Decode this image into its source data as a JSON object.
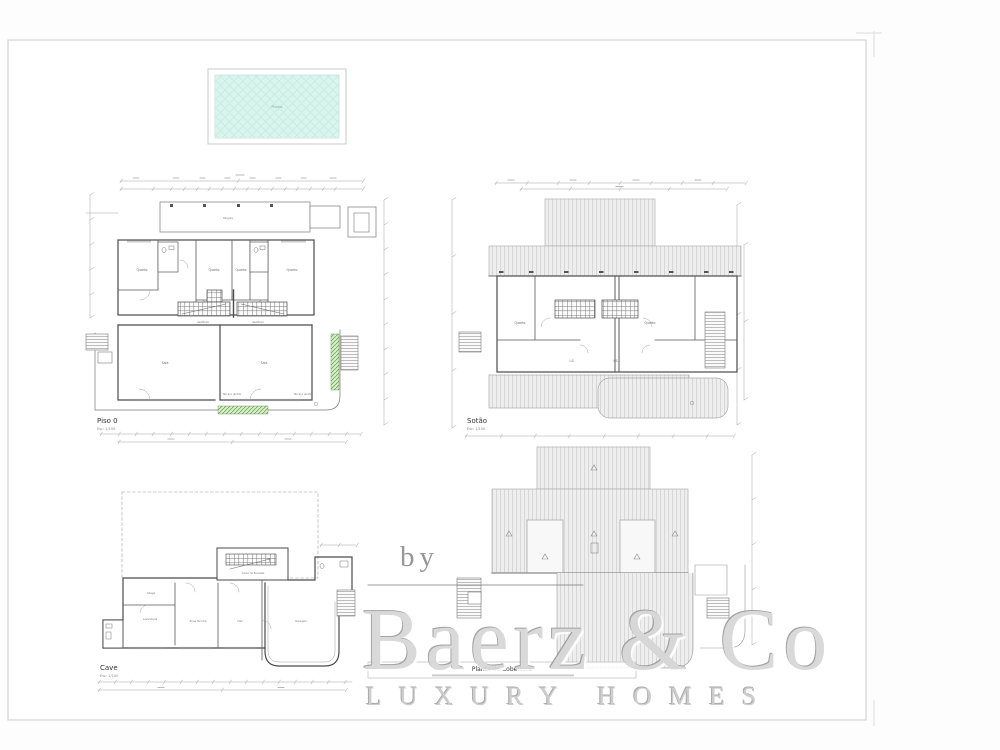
{
  "pool": {
    "label": "Piscina"
  },
  "plans": {
    "piso0": {
      "title": "Piso 0",
      "scale": "Esc: 1/100",
      "rooms": {
        "pergola": "Pérgola",
        "quarto1": "Quarto",
        "quarto2": "Quarto",
        "quarto3": "Quarto",
        "quarto4": "Quarto",
        "vestibulo1": "Vestíbulo",
        "vestibulo2": "Vestíbulo",
        "sala1": "Sala",
        "sala2": "Sala",
        "terraco1": "Terraço jardim",
        "terraco2": "Terraço jardim"
      }
    },
    "sotao": {
      "title": "Sotão",
      "scale": "Esc: 1/100",
      "rooms": {
        "quarto_esq": "Quarto",
        "quarto_dir": "Quarto",
        "is_esq": "I.S.",
        "is_dir": "I.S."
      }
    },
    "cave": {
      "title": "Cave",
      "scale": "Esc: 1/100",
      "rooms": {
        "escadas": "Caixa de Escadas",
        "adega": "Adega",
        "lavandaria": "Lavandaria",
        "zona_tecnica": "Zona Técnica",
        "hall": "Hall",
        "garagem": "Garagem"
      }
    },
    "cobertura": {
      "title": "Planta de Cobertura"
    }
  },
  "watermark": {
    "by": "by",
    "name": "Baerz & Co",
    "tagline": "LUXURY HOMES"
  },
  "colors": {
    "pool_water": "#d9f5ed",
    "planter_green": "#6fae57",
    "roof_hatch": "#eeeeee",
    "wall_line": "#4a4a4a",
    "watermark_gray": "#d6d6d6"
  }
}
